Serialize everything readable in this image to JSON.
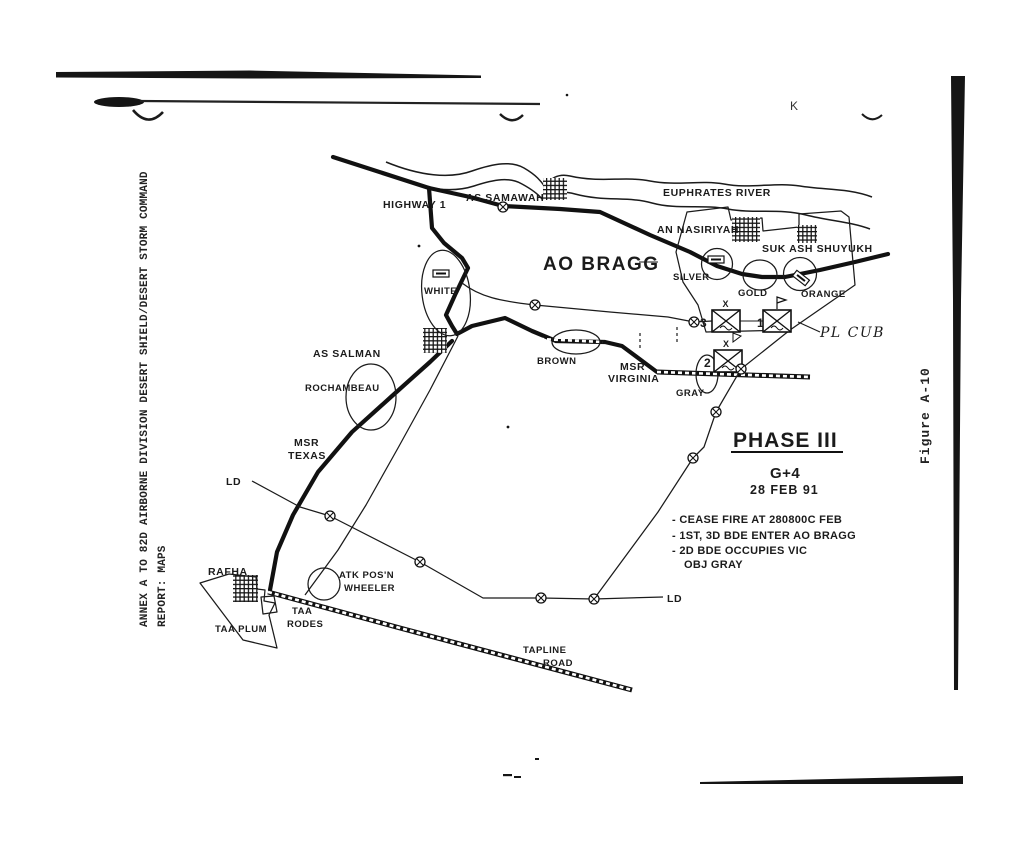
{
  "page": {
    "margin_note_line1": "ANNEX A TO 82D AIRBORNE DIVISION DESERT SHIELD/DESERT STORM COMMAND",
    "margin_note_line2": "REPORT:  MAPS",
    "figure_caption": "Figure A-10",
    "stray_mark": "K"
  },
  "colors": {
    "ink": "#1b1b1b",
    "paper": "#ffffff"
  },
  "map": {
    "river_label": "EUPHRATES RIVER",
    "road_labels": {
      "highway1": "HIGHWAY 1",
      "msr_texas_1": "MSR",
      "msr_texas_2": "TEXAS",
      "msr_virginia_1": "MSR",
      "msr_virginia_2": "VIRGINIA",
      "tapline_1": "TAPLINE",
      "tapline_2": "ROAD"
    },
    "cities": {
      "as_samawah": "AS SAMAWAH",
      "an_nasiriyah": "AN NASIRIYAH",
      "suk_ash_shuyukh": "SUK ASH SHUYUKH",
      "as_salman": "AS SALMAN",
      "rafha": "RAFHA"
    },
    "areas": {
      "ao_bragg": "AO BRAGG",
      "taa_plum": "TAA PLUM",
      "taa_rodes_1": "TAA",
      "taa_rodes_2": "RODES",
      "atk_posn_1": "ATK POS'N",
      "atk_posn_2": "WHEELER"
    },
    "objectives": {
      "white": "WHITE",
      "silver": "SILVER",
      "gold": "GOLD",
      "orange": "ORANGE",
      "brown": "BROWN",
      "gray": "GRAY",
      "rochambeau": "ROCHAMBEAU"
    },
    "control_measures": {
      "pl_cub": "PL CUB",
      "ld_west": "LD",
      "ld_south": "LD"
    },
    "units": {
      "bde_1": "1",
      "bde_2": "2",
      "bde_3": "3",
      "echelon": "X"
    },
    "phase_box": {
      "title": "PHASE III",
      "g_day": "G+4",
      "date": "28 FEB 91",
      "notes": [
        "- CEASE FIRE AT 280800C FEB",
        "- 1ST, 3D BDE ENTER AO BRAGG",
        "- 2D BDE OCCUPIES VIC",
        "OBJ GRAY"
      ]
    }
  }
}
